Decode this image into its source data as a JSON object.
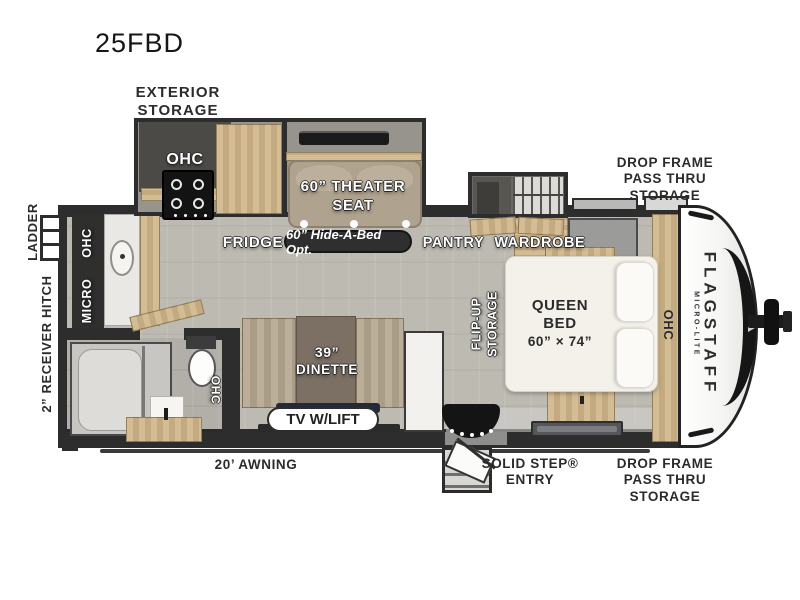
{
  "title": "25FBD",
  "brand": {
    "name": "FLAGSTAFF",
    "model": "MICRO-LITE"
  },
  "colors": {
    "wall": "#2d2d2d",
    "floor": "#bdbab2",
    "slide_floor": "#97948d",
    "wood": "#c9b189",
    "mattress": "#f3f1ea",
    "seat_tan": "#b1a490",
    "table_brown": "#7c7065",
    "badge_dark": "#2f2f2f"
  },
  "callouts": {
    "exterior_storage": {
      "l1": "EXTERIOR",
      "l2": "STORAGE"
    },
    "drop_frame_top": {
      "l1": "DROP FRAME",
      "l2": "PASS THRU",
      "l3": "STORAGE"
    },
    "drop_frame_bottom": {
      "l1": "DROP FRAME",
      "l2": "PASS THRU",
      "l3": "STORAGE"
    },
    "ladder": "LADDER",
    "receiver_hitch": "2” RECEIVER HITCH",
    "awning": "20’ AWNING",
    "solid_step": {
      "l1": "SOLID STEP®",
      "l2": "ENTRY"
    }
  },
  "features": {
    "kitchen": {
      "ohc_slide": "OHC",
      "fridge": "FRIDGE",
      "ohc_rear": "OHC",
      "micro": "MICRO"
    },
    "living": {
      "theater": {
        "l1": "60” THEATER",
        "l2": "SEAT"
      },
      "hide_a_bed": "60” Hide-A-Bed Opt.",
      "dinette": {
        "l1": "39”",
        "l2": "DINETTE"
      },
      "tv": "TV W/LIFT"
    },
    "pantry": "PANTRY",
    "wardrobe": "WARDROBE",
    "bath": {
      "ohc": "OHC"
    },
    "bedroom": {
      "flip_up": {
        "l1": "FLIP-UP",
        "l2": "STORAGE"
      },
      "queen_bed": {
        "l1": "QUEEN",
        "l2": "BED",
        "l3": "60” × 74”"
      },
      "ohc": "OHC"
    }
  }
}
